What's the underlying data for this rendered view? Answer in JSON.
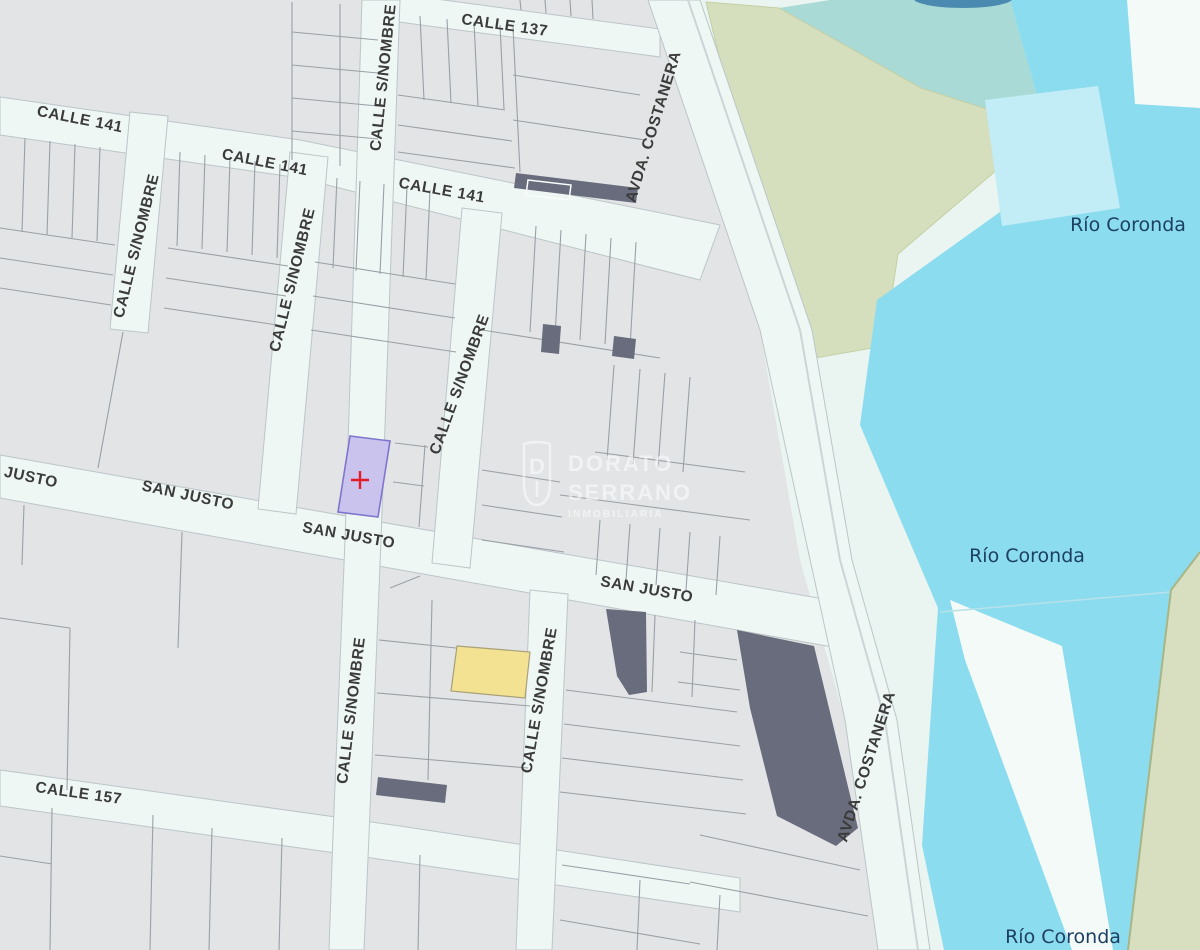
{
  "map": {
    "streets": {
      "calle_137": "CALLE 137",
      "calle_141": "CALLE 141",
      "calle_sin_nombre": "CALLE S/NOMBRE",
      "san_justo": "SAN JUSTO",
      "san_justo_clipped": "JUSTO",
      "calle_157": "CALLE 157",
      "avda_costanera": "AVDA. COSTANERA"
    },
    "water": {
      "river_name": "Río Coronda"
    },
    "watermark": {
      "name_line1": "DORATO",
      "name_line2": "SERRANO",
      "tagline": "INMOBILIARIA"
    },
    "selected_parcel": {
      "marker_symbol": "+",
      "fill": "#c9c3ee",
      "border": "#7e76cc",
      "marker_color": "#e31a2b"
    },
    "highlighted_parcel_yellow": "#f2e292",
    "colors": {
      "parcel_base": "#e2e4e5",
      "parcel_line": "#9aa0a6",
      "parcel_dark": "#686c7c",
      "street_fill": "#eef7f4",
      "street_border": "#bcc5c8",
      "water": "#8bdcee",
      "water_light": "#c2ecf6",
      "water_dark_top": "#4b8ab0",
      "land_green": "#d6dfbd",
      "land_green_edge": "#a8b585",
      "land_teal": "#a9dad6",
      "shore_mint": "#eaf5f1",
      "sandbar_white": "#f3faf7",
      "street_label": "#3b3b3b",
      "river_label": "#1c3f63",
      "watermark_white": "#ffffff"
    }
  }
}
